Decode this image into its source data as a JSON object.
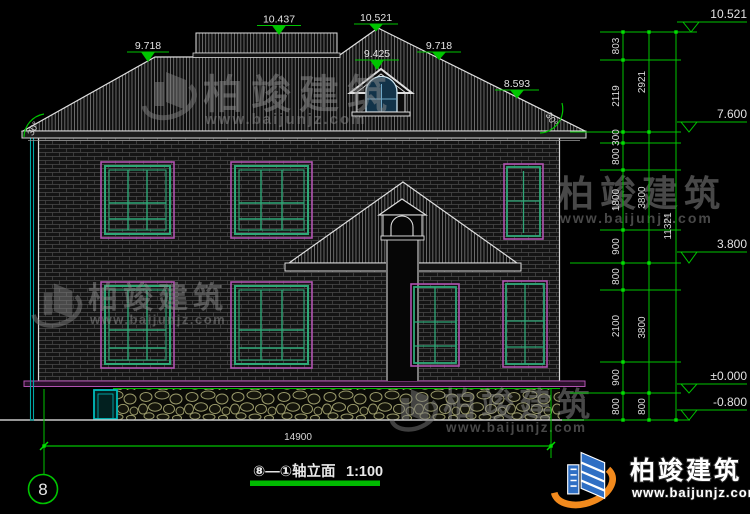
{
  "drawing": {
    "axis_bubble": "8",
    "title": "⑧—①轴立面",
    "scale": "1:100",
    "bottom_overall_dim": "14900"
  },
  "roof_markers": [
    "9.718",
    "10.437",
    "10.521",
    "9.425",
    "9.718",
    "8.593"
  ],
  "roof_angles": [
    "30°",
    "30°"
  ],
  "levels": [
    "10.521",
    "7.600",
    "3.800",
    "±0.000",
    "-0.800"
  ],
  "dims": {
    "inner": [
      "803",
      "2119",
      "300",
      "800",
      "1800",
      "900",
      "800",
      "2100",
      "900",
      "800"
    ],
    "middle": [
      "2921",
      "3800",
      "3800",
      "800"
    ],
    "overall": "11321"
  },
  "watermark": {
    "name": "柏竣建筑",
    "url": "www.baijunjz.com"
  },
  "logo": {
    "name": "柏竣建筑",
    "url": "www.baijunjz.com"
  },
  "colors": {
    "dim_green": "#00c400",
    "window_green": "#2fa878",
    "trim_magenta": "#b052b0",
    "pipe_teal": "#00b8b8",
    "stone_tan": "#9a9a6a",
    "logo_orange": "#f28a1d",
    "logo_blue": "#2f6fc4",
    "line_white": "#e0e0e0"
  }
}
